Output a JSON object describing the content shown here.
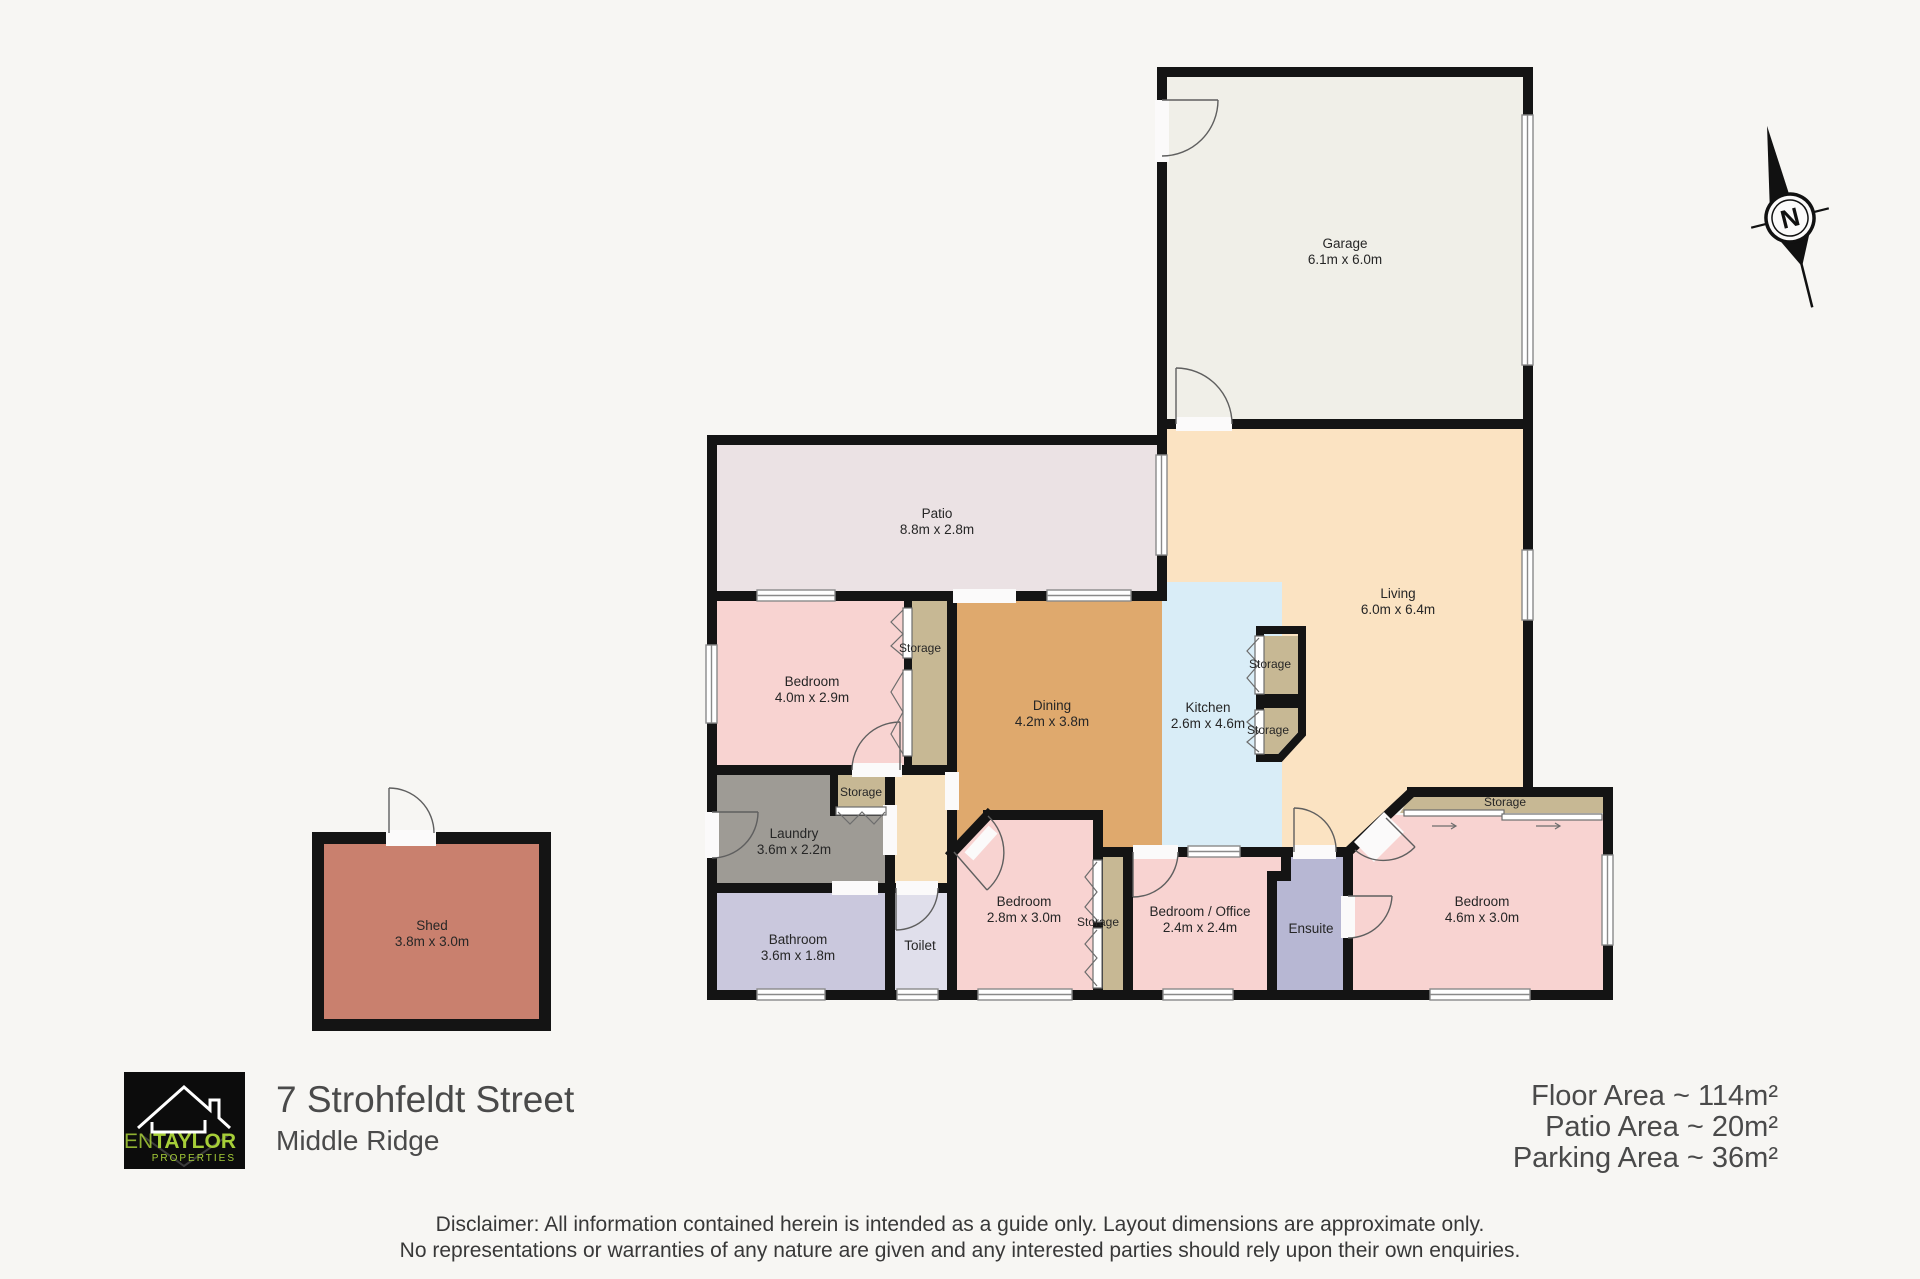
{
  "plan": {
    "rooms": {
      "garage": {
        "name": "Garage",
        "dims": "6.1m x 6.0m"
      },
      "patio": {
        "name": "Patio",
        "dims": "8.8m x 2.8m"
      },
      "living": {
        "name": "Living",
        "dims": "6.0m x 6.4m"
      },
      "dining": {
        "name": "Dining",
        "dims": "4.2m x 3.8m"
      },
      "kitchen": {
        "name": "Kitchen",
        "dims": "2.6m x 4.6m"
      },
      "bedroom_top": {
        "name": "Bedroom",
        "dims": "4.0m x 2.9m"
      },
      "laundry": {
        "name": "Laundry",
        "dims": "3.6m x 2.2m"
      },
      "bathroom": {
        "name": "Bathroom",
        "dims": "3.6m x 1.8m"
      },
      "toilet": {
        "name": "Toilet"
      },
      "bedroom_mid": {
        "name": "Bedroom",
        "dims": "2.8m x 3.0m"
      },
      "bedroom_office": {
        "name": "Bedroom / Office",
        "dims": "2.4m x 2.4m"
      },
      "ensuite": {
        "name": "Ensuite"
      },
      "bedroom_right": {
        "name": "Bedroom",
        "dims": "4.6m x 3.0m"
      },
      "shed": {
        "name": "Shed",
        "dims": "3.8m x 3.0m"
      }
    },
    "storage_label": "Storage",
    "compass": {
      "label": "N"
    },
    "colors": {
      "wall": "#141414",
      "garage": "#f0efe8",
      "patio": "#ebe2e4",
      "living": "#fbe3c2",
      "hall": "#f6e0bd",
      "dining": "#dfa96d",
      "kitchen": "#d9edf7",
      "bedroom": "#f8d3d1",
      "laundry": "#9e9b95",
      "bathroom": "#cac8dd",
      "toilet": "#e0dfeb",
      "ensuite": "#b7b7d3",
      "storage": "#c7b894",
      "shed": "#c9806e",
      "opening": "#fbfafa"
    }
  },
  "footer": {
    "logo": {
      "brand_thin": "JEN",
      "brand_bold": "TAYLOR",
      "brand_sub": "PROPERTIES",
      "accent": "#a6ce38"
    },
    "address": {
      "line1": "7 Strohfeldt Street",
      "line2": "Middle Ridge"
    },
    "areas": {
      "floor": "Floor Area ~ 114m²",
      "patio": "Patio Area ~ 20m²",
      "parking": "Parking Area ~ 36m²"
    },
    "disclaimer": {
      "line1": "Disclaimer: All information contained herein is intended as a guide only. Layout dimensions are approximate only.",
      "line2": "No representations or warranties of any nature are given and any interested parties should rely upon their own enquiries."
    }
  }
}
